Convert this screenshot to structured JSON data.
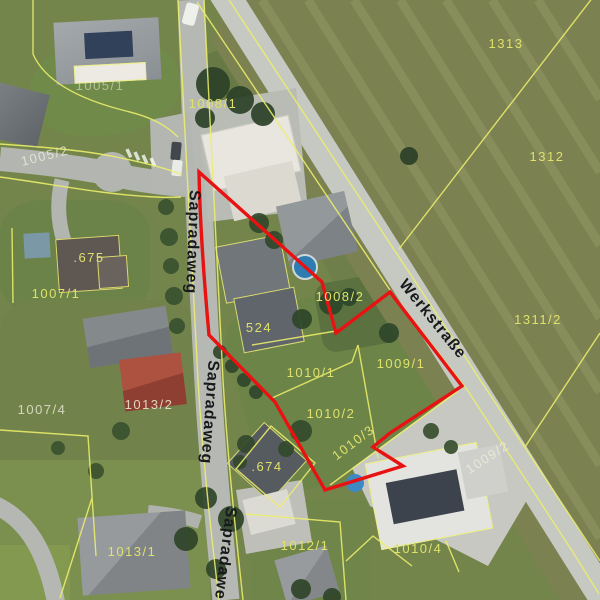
{
  "map": {
    "streets": {
      "sapradaweg_top": "Sapradaweg",
      "sapradaweg_mid": "Sapradaweg",
      "sapradaweg_bottom": "Sapradaweg",
      "werkstrasse": "Werkstraße"
    },
    "parcels": {
      "p1005_1": "1005/1",
      "p1005_2": "1005/2",
      "p1008_1": "1008/1",
      "p1313": "1313",
      "p1312": "1312",
      "p1311_2": "1311/2",
      "b675": ".675",
      "p1007_1": "1007/1",
      "p1007_4": "1007/4",
      "p1013_2": "1013/2",
      "b524": "524",
      "p1008_2": "1008/2",
      "p1009_1": "1009/1",
      "p1010_1": "1010/1",
      "p1010_2": "1010/2",
      "p1010_3": "1010/3",
      "b674": ".674",
      "p1012_1": "1012/1",
      "p1010_4": "1010/4",
      "p1013_1": "1013/1",
      "p1009_2": "1009/2"
    },
    "colors": {
      "selection_outline": "#e81212",
      "cadastral_line": "#edef6b",
      "parcel_label": "#dfe16a"
    }
  }
}
